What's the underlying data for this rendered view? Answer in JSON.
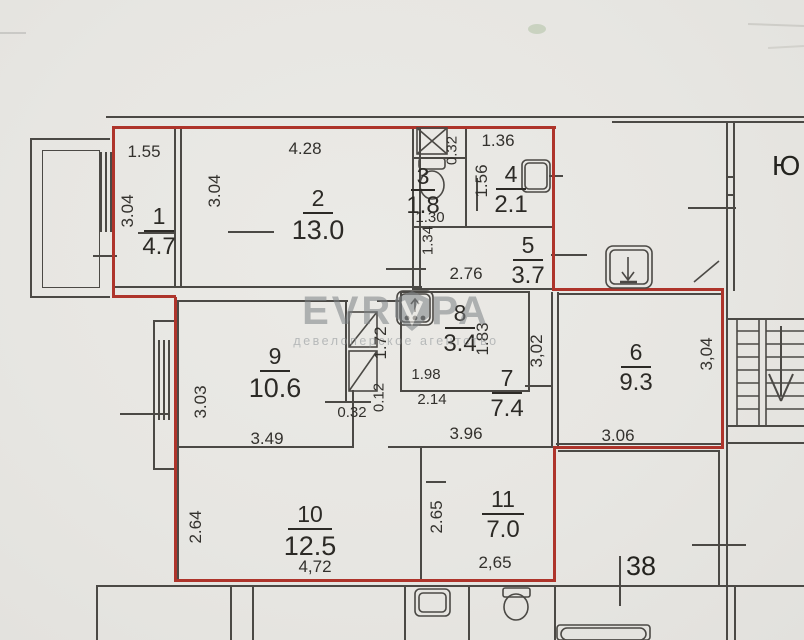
{
  "colors": {
    "paper": "#e9e8e4",
    "wall": "#4b4945",
    "boundary": "#ae342b",
    "text": "#32302c",
    "watermark_gray": "#9ba0a3"
  },
  "compass": {
    "label": "Ю"
  },
  "neighbor": {
    "apartment_number": "38"
  },
  "watermark": {
    "brand_left": "EVR",
    "brand_right": "PA",
    "subtitle": "девелоперское агентство"
  },
  "rooms": [
    {
      "number": "1",
      "area": "4.7"
    },
    {
      "number": "2",
      "area": "13.0"
    },
    {
      "number": "3",
      "area": "1.8"
    },
    {
      "number": "4",
      "area": "2.1"
    },
    {
      "number": "5",
      "area": "3.7"
    },
    {
      "number": "6",
      "area": "9.3"
    },
    {
      "number": "7",
      "area": "7.4"
    },
    {
      "number": "8",
      "area": "3.4"
    },
    {
      "number": "9",
      "area": "10.6"
    },
    {
      "number": "10",
      "area": "12.5"
    },
    {
      "number": "11",
      "area": "7.0"
    }
  ],
  "dimensions": [
    {
      "text": "1.55"
    },
    {
      "text": "4.28"
    },
    {
      "text": "1.36"
    },
    {
      "text": "0.32"
    },
    {
      "text": "3.04"
    },
    {
      "text": "3.04"
    },
    {
      "text": "1.56"
    },
    {
      "text": "1.30"
    },
    {
      "text": "1.34"
    },
    {
      "text": "2.76"
    },
    {
      "text": "1.72"
    },
    {
      "text": "0.12"
    },
    {
      "text": "1.98"
    },
    {
      "text": "2.14"
    },
    {
      "text": "0.32"
    },
    {
      "text": "1.83"
    },
    {
      "text": "3,02"
    },
    {
      "text": "3.03"
    },
    {
      "text": "3.49"
    },
    {
      "text": "3.96"
    },
    {
      "text": "3.06"
    },
    {
      "text": "3,04"
    },
    {
      "text": "2.64"
    },
    {
      "text": "4,72"
    },
    {
      "text": "2,65"
    },
    {
      "text": "2.65"
    }
  ]
}
